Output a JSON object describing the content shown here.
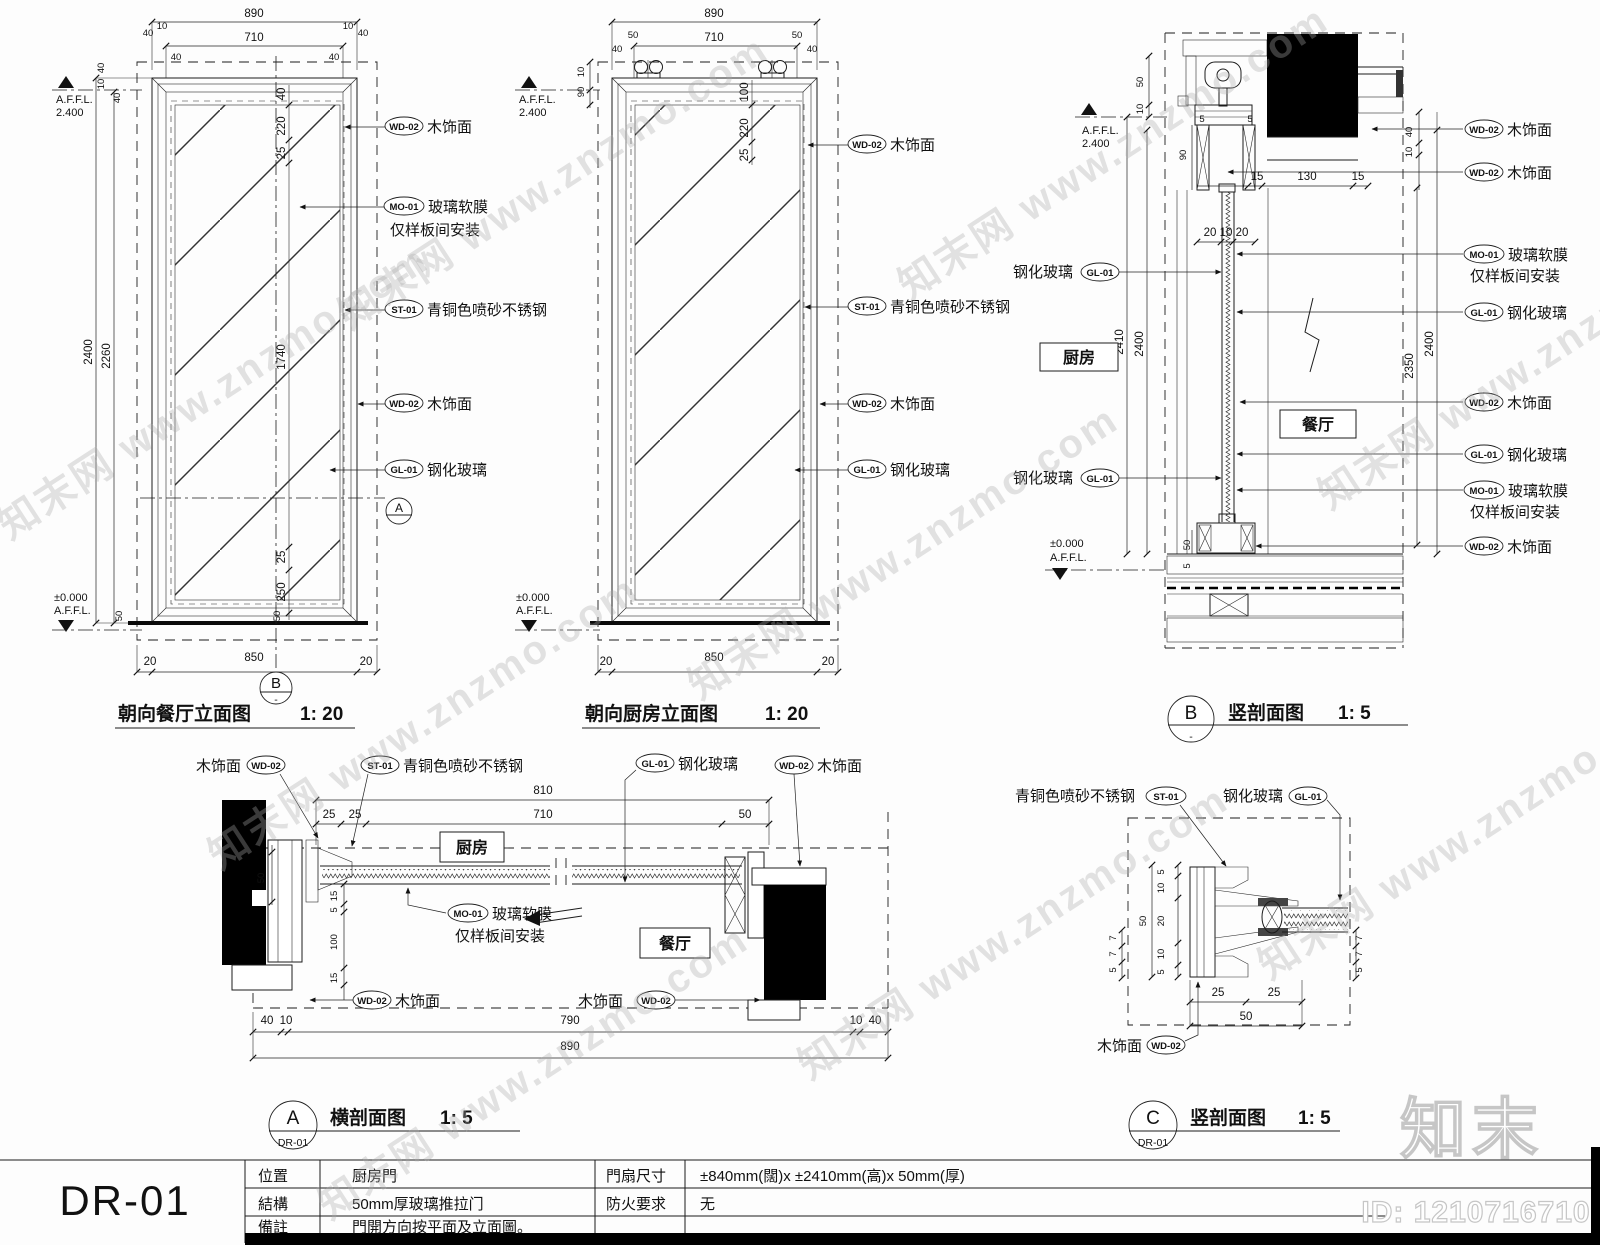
{
  "watermark": {
    "text": "知末网 www.znzmo.com"
  },
  "brand": {
    "logo": "知末",
    "id_label": "ID: 1210716710"
  },
  "materials": {
    "wd02": {
      "code": "WD-02",
      "label": "木饰面"
    },
    "mo01": {
      "code": "MO-01",
      "label": "玻璃软膜",
      "label2": "仅样板间安装"
    },
    "st01": {
      "code": "ST-01",
      "label": "青铜色喷砂不锈钢"
    },
    "gl01": {
      "code": "GL-01",
      "label": "钢化玻璃"
    }
  },
  "rooms": {
    "kitchen": "厨房",
    "dining": "餐厅"
  },
  "levels": {
    "affl": "A.F.F.L.",
    "top": "2.400",
    "zero": "±0.000"
  },
  "views": {
    "elev_dining": {
      "title": "朝向餐厅立面图",
      "scale": "1: 20"
    },
    "elev_kitchen": {
      "title": "朝向厨房立面图",
      "scale": "1: 20"
    },
    "sec_b": {
      "bubble": "B",
      "sub": "-",
      "title": "竖剖面图",
      "scale": "1: 5"
    },
    "sec_a": {
      "bubble": "A",
      "sub": "DR-01",
      "title": "横剖面图",
      "scale": "1: 5"
    },
    "sec_c": {
      "bubble": "C",
      "sub": "DR-01",
      "title": "竖剖面图",
      "scale": "1: 5"
    }
  },
  "dims": {
    "v5": "5",
    "v7": "7",
    "v10": "10",
    "v15": "15",
    "v20": "20",
    "v25": "25",
    "v40": "40",
    "v50": "50",
    "v90": "90",
    "v100": "100",
    "v130": "130",
    "v220": "220",
    "v250": "250",
    "v710": "710",
    "v790": "790",
    "v810": "810",
    "v850": "850",
    "v890": "890",
    "v1740": "1740",
    "v2260": "2260",
    "v2350": "2350",
    "v2400": "2400",
    "v2410": "2410",
    "v201020": "20 10 20"
  },
  "title_block": {
    "code": "DR-01",
    "rows": [
      {
        "k1": "位置",
        "v1": "厨房門",
        "k2": "門扇尺寸",
        "v2": "±840mm(闊)x ±2410mm(高)x 50mm(厚)"
      },
      {
        "k1": "結構",
        "v1": "50mm厚玻璃推拉门",
        "k2": "防火要求",
        "v2": "无"
      },
      {
        "k1": "備註",
        "v1": "門開方向按平面及立面圖。",
        "k2": "",
        "v2": ""
      }
    ]
  }
}
